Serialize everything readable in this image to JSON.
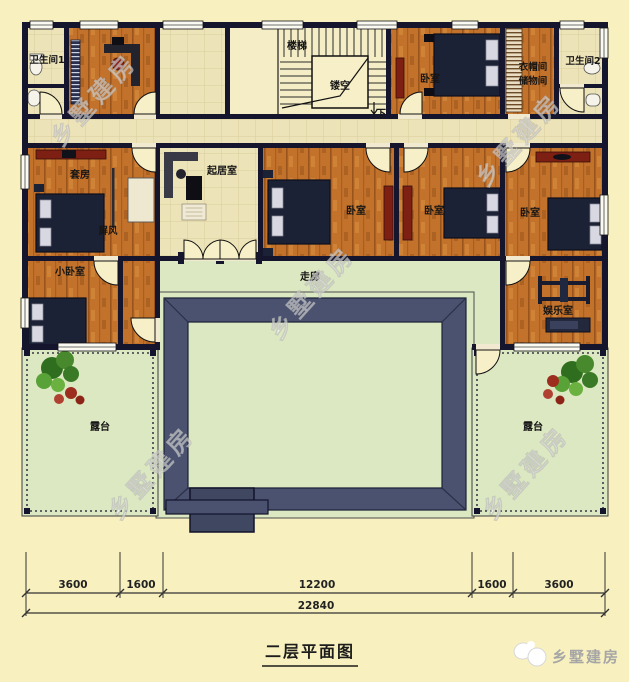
{
  "meta": {
    "title": "二层平面图",
    "brand": "乡墅建房",
    "watermark": "乡墅建房"
  },
  "rooms": {
    "bathroom1": "卫生间1",
    "stairs": "楼梯",
    "void": "镂空",
    "down": "下",
    "bedroom_top": "卧室",
    "cloakroom_line1": "衣帽间",
    "cloakroom_line2": "储物间",
    "bathroom2": "卫生间2",
    "suite": "套房",
    "screen": "屏风",
    "living": "起居室",
    "bedroom_a": "卧室",
    "bedroom_b": "卧室",
    "bedroom_c": "卧室",
    "small_bedroom": "小卧室",
    "corridor": "走廊",
    "entertainment": "娱乐室",
    "terrace_left": "露台",
    "terrace_right": "露台"
  },
  "dimensions": {
    "segments": [
      "3600",
      "1600",
      "12200",
      "1600",
      "3600"
    ],
    "total": "22840"
  },
  "colors": {
    "wall": "#16152e",
    "wood": "#c3722b",
    "tile": "#ede3b8",
    "green": "#dce8c2",
    "slate": "#4a5270",
    "accent_red": "#7e1f14",
    "background": "#f8f1bf"
  }
}
